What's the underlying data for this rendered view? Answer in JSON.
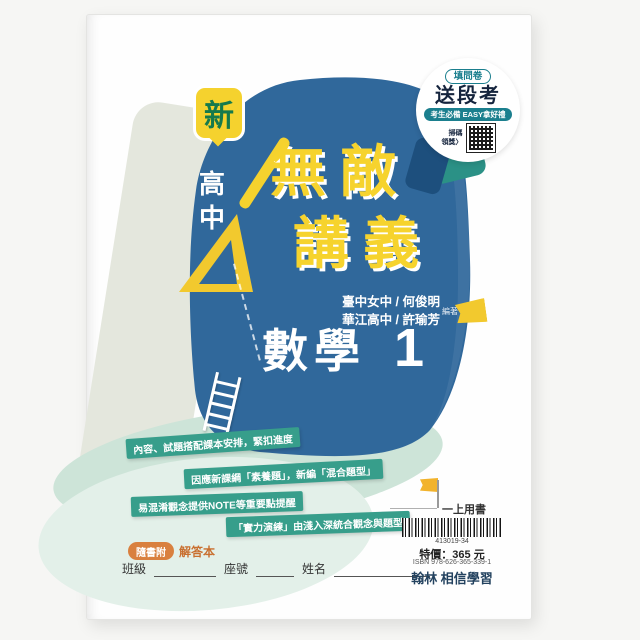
{
  "promo": {
    "tag": "填問卷",
    "headline": "送段考",
    "subline": "考生必備 EASY拿好禮",
    "scan": "掃碼",
    "claim": "領獎〉"
  },
  "badges": {
    "new": "新",
    "level": "高中"
  },
  "title": {
    "line1": "無敵",
    "line2": "講義"
  },
  "authors": {
    "line1": "臺中女中 / 何俊明",
    "line2": "華江高中 / 許瑜芳",
    "role": "編著"
  },
  "subject": {
    "name": "數學",
    "volume": "1"
  },
  "features": [
    "內容、試題搭配課本安排，緊扣進度",
    "因應新課綱「素養題」，新編「混合題型」",
    "易混淆觀念提供NOTE等重要點提醒",
    "「實力演練」由淺入深統合觀念與題型"
  ],
  "bonus": {
    "badge": "隨書附",
    "text": "解答本"
  },
  "student": {
    "class_label": "班級",
    "seat_label": "座號",
    "name_label": "姓名"
  },
  "sales": {
    "usage": "一上用書",
    "barcode_number": "413019-34",
    "price": "特價：365 元",
    "isbn": "ISBN 978-626-365-339-1",
    "publisher": "翰林 相信學習"
  },
  "colors": {
    "cover_blue": "#30689b",
    "accent_teal": "#2b9186",
    "accent_yellow": "#f5d22e",
    "accent_orange": "#d9803f",
    "feature_green": "#379e8b"
  }
}
